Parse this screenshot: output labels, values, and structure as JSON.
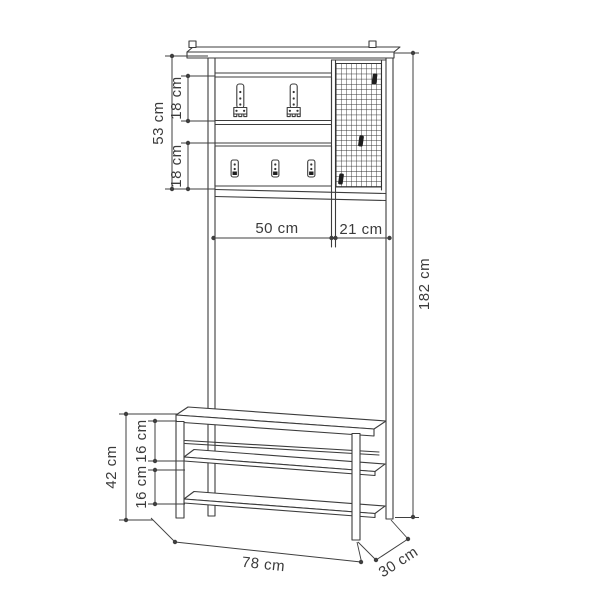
{
  "diagram": {
    "title": "Hall stand with coat hooks, mesh panel and shoe bench — dimension drawing",
    "unit": "cm",
    "line_color": "#3c3c3c",
    "background_color": "#ffffff",
    "dims": {
      "upper_section_height": "53 cm",
      "hook_panel_top_height": "18 cm",
      "hook_panel_bottom_height": "18 cm",
      "panel_width": "50 cm",
      "mesh_panel_width": "21 cm",
      "total_height": "182 cm",
      "bench_height": "42 cm",
      "shelf_gap_top": "16 cm",
      "shelf_gap_bottom": "16 cm",
      "total_width": "78 cm",
      "depth": "30 cm"
    }
  }
}
